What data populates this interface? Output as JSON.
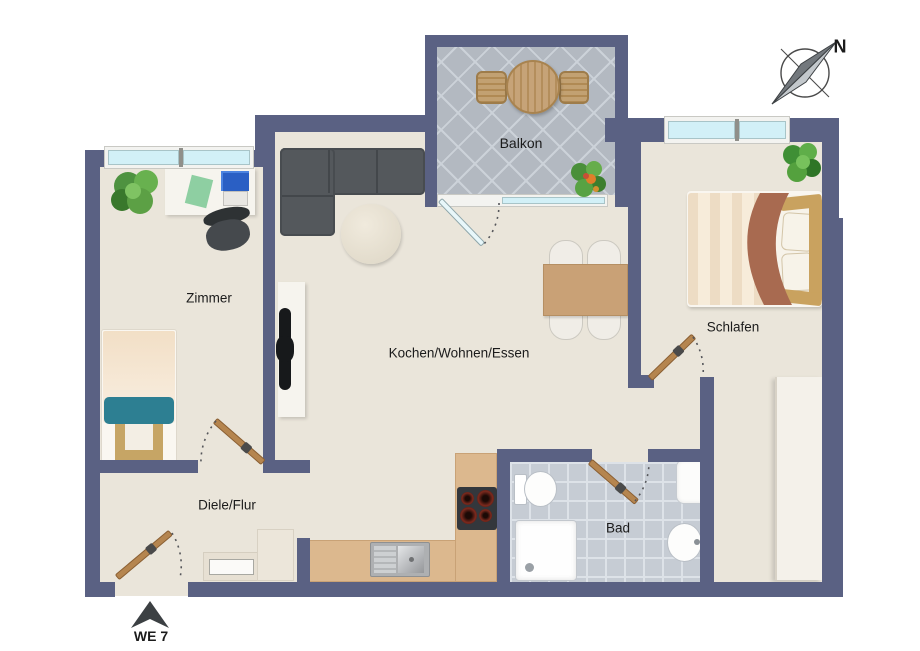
{
  "plan_title": "Apartment floor plan WE 7",
  "labels": {
    "balkon": "Balkon",
    "zimmer": "Zimmer",
    "kochen": "Kochen/Wohnen/Essen",
    "schlafen": "Schlafen",
    "diele": "Diele/Flur",
    "bad": "Bad",
    "unit": "WE 7",
    "north": "N"
  },
  "palette": {
    "wall": "#5a6183",
    "floor": "#eae5da",
    "balcony_tile": "#b3b9c1",
    "bath_tile": "#c6ccd4",
    "kitchen_counter": "#dcb88e",
    "wood_door": "#b5854f",
    "window_glass": "#d2f0f7",
    "sofa": "#54585c",
    "dining_table": "#c9a176",
    "bed_throw": "#a86a50",
    "teal_blanket": "#2d7f92",
    "text": "#1b1b1b"
  },
  "rooms": [
    "Zimmer",
    "Kochen/Wohnen/Essen",
    "Schlafen",
    "Diele/Flur",
    "Bad",
    "Balkon"
  ],
  "fixtures": [
    "sofa",
    "coffee-table",
    "tv",
    "dining-table",
    "kitchen-counter",
    "sink",
    "cooktop",
    "toilet",
    "shower",
    "washbasin",
    "single-bed",
    "double-bed",
    "wardrobe",
    "desk",
    "office-chair",
    "balcony-table",
    "balcony-chairs"
  ]
}
